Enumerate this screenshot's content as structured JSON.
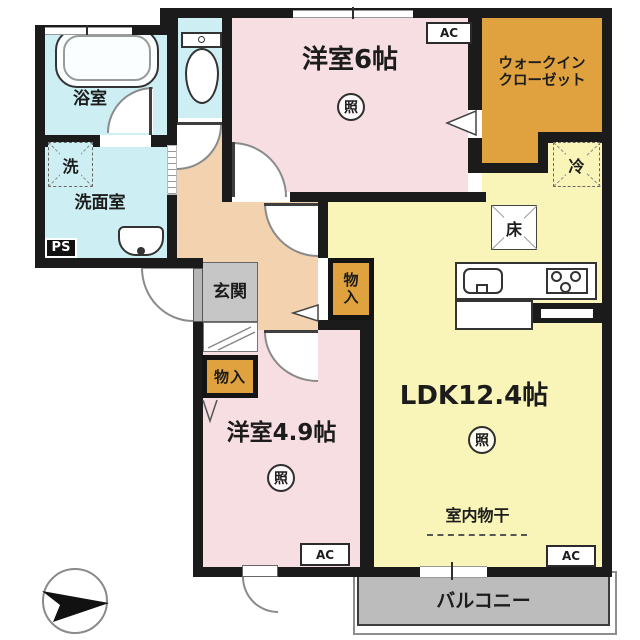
{
  "plan_type": "japanese-apartment-floor-plan",
  "rooms": {
    "bath": {
      "name": "浴室"
    },
    "washroom": {
      "name": "洗面室",
      "washer_mark": "洗",
      "pipe_space": "PS"
    },
    "western6": {
      "name": "洋室6帖",
      "light_mark": "照",
      "ac_mark": "AC"
    },
    "wic": {
      "name_line1": "ウォークイン",
      "name_line2": "クローゼット"
    },
    "ldk": {
      "name": "LDK12.4帖",
      "light_mark": "照",
      "ac_mark": "AC",
      "fridge_mark": "冷",
      "floor_hatch_mark": "床",
      "indoor_drying_label": "室内物干"
    },
    "western49": {
      "name": "洋室4.9帖",
      "light_mark": "照",
      "ac_mark": "AC"
    },
    "entrance": {
      "name": "玄関"
    },
    "storage_hall": {
      "name": "物入"
    },
    "storage_west49": {
      "name": "物入"
    },
    "balcony": {
      "name": "バルコニー"
    }
  },
  "colors": {
    "wall": "#1b1b1b",
    "wet_room": "#cdeef3",
    "bedroom": "#f7dee2",
    "closet": "#e0a23e",
    "ldk": "#f9f5b8",
    "hall": "#f3d2b0",
    "entrance_box": "#c6c6c6",
    "balcony": "#bcbcbc"
  }
}
